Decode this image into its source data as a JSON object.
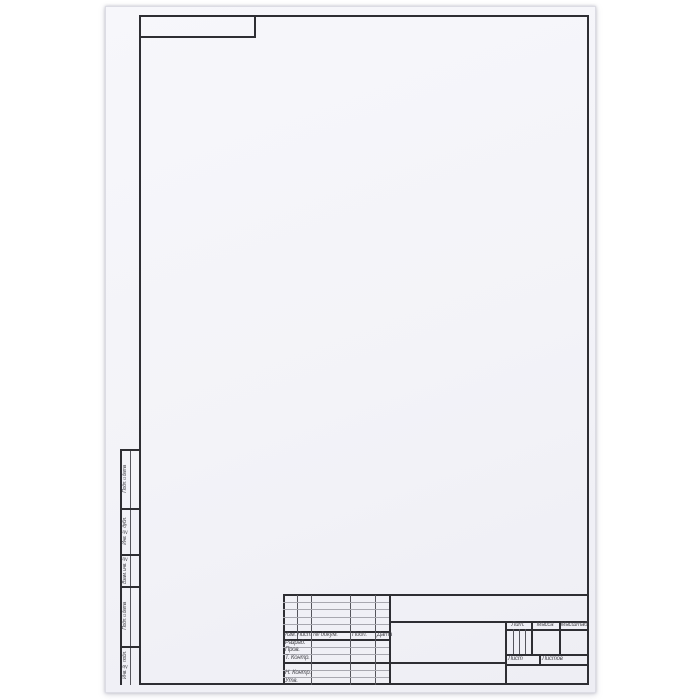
{
  "title_block": {
    "revision_header": {
      "izm": "Изм.",
      "list": "Лист",
      "doc_num": "№ докум.",
      "podp": "Подп.",
      "data": "Дата"
    },
    "signature_rows": [
      {
        "label": "Разраб."
      },
      {
        "label": "Пров."
      },
      {
        "label": "Т. Контр."
      },
      {
        "label": ""
      },
      {
        "label": "Н. Контр."
      },
      {
        "label": "Утв."
      }
    ],
    "right_section": {
      "lit": "Лит.",
      "massa": "Масса",
      "masshtab": "Масштаб",
      "sheet": "Лист",
      "sheets": "Листов"
    }
  },
  "margin_stamps": {
    "items": [
      "Подп. и дата",
      "Инв. № дубл.",
      "Взам. инв. №",
      "Подп. и дата",
      "Инв. № подл."
    ]
  },
  "colors": {
    "paper": "#f4f4f8",
    "line_thick": "#2e2e33",
    "line_thin": "#a8a8b0",
    "text": "#4a4a50",
    "background": "#ffffff"
  }
}
